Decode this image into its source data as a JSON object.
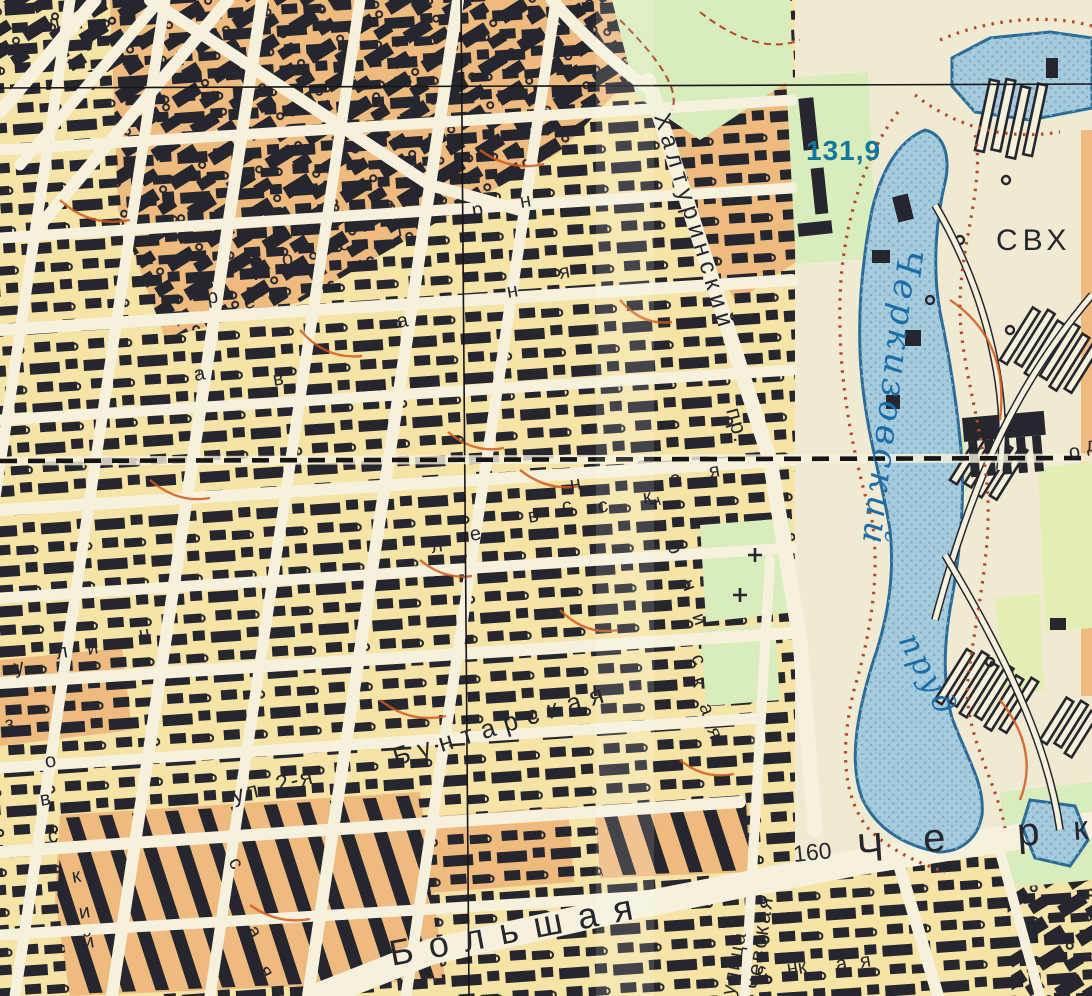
{
  "colors": {
    "paper": "#f1ead3",
    "street": "#f6f1dc",
    "block-yellow": "#f6e3a6",
    "block-orange": "#eeba7e",
    "park-green": "#d9ecbc",
    "park-green2": "#e3eeb2",
    "pond": "#a6cbdc",
    "pond-dot": "#7fb2c8",
    "pond-line": "#2a6b97",
    "ink": "#26262e",
    "grid": "#161616",
    "hachure": "#b04a2a",
    "redline": "#d2591c",
    "blue-text": "#14789c",
    "pond-text": "#1a6da8"
  },
  "map": {
    "labels": [
      {
        "id": "pond-elevation",
        "text": "131,9",
        "x": 806,
        "y": 160,
        "rot": 0,
        "size": 28,
        "color": "blue-text",
        "weight": "bold",
        "spacing": 1
      },
      {
        "id": "sovkhoz",
        "text": "СВХ",
        "x": 996,
        "y": 250,
        "rot": 0,
        "size": 30,
        "color": "ink",
        "spacing": 5
      },
      {
        "id": "street-khalturinsky",
        "text": "Халтуринский",
        "x": 654,
        "y": 116,
        "rot": 73,
        "size": 24,
        "color": "ink",
        "spacing": 6
      },
      {
        "id": "khalturinsky-abbr",
        "text": "пр.",
        "x": 726,
        "y": 410,
        "rot": 75,
        "size": 22,
        "color": "ink",
        "spacing": 2
      },
      {
        "id": "pond-name",
        "text": "Черкизовский",
        "x": 899,
        "y": 248,
        "rot": 97,
        "size": 34,
        "color": "pond-text",
        "italic": true,
        "spacing": 4
      },
      {
        "id": "pond-word",
        "text": "пруд",
        "x": 898,
        "y": 640,
        "rot": 62,
        "size": 31,
        "color": "pond-text",
        "italic": true,
        "spacing": 3
      },
      {
        "id": "street-bolshaya",
        "text": "Большая",
        "x": 392,
        "y": 966,
        "rot": -11,
        "size": 36,
        "color": "ink",
        "spacing": 16
      },
      {
        "id": "house-number-160",
        "text": "160",
        "x": 794,
        "y": 862,
        "rot": -6,
        "size": 23,
        "color": "ink",
        "spacing": 0
      },
      {
        "id": "cherkizovskaya-ch",
        "text": "Ч",
        "x": 858,
        "y": 862,
        "rot": -4,
        "size": 40,
        "color": "ink",
        "spacing": 0
      },
      {
        "id": "cherkizovskaya-e",
        "text": "е",
        "x": 924,
        "y": 852,
        "rot": -4,
        "size": 40,
        "color": "ink",
        "spacing": 0
      },
      {
        "id": "cherkizovskaya-r",
        "text": "р",
        "x": 1018,
        "y": 846,
        "rot": -4,
        "size": 40,
        "color": "ink",
        "spacing": 0
      },
      {
        "id": "cherkizovskaya-k",
        "text": "к",
        "x": 1074,
        "y": 840,
        "rot": -4,
        "size": 34,
        "color": "ink",
        "spacing": 0
      },
      {
        "id": "street-ul-2ya",
        "text": "ул. 2-я",
        "x": 234,
        "y": 803,
        "rot": -14,
        "size": 23,
        "color": "ink",
        "spacing": 2
      },
      {
        "id": "street-buntarskaya",
        "text": "Бунтарская",
        "x": 396,
        "y": 766,
        "rot": -17,
        "size": 26,
        "color": "ink",
        "spacing": 9
      },
      {
        "id": "street-chevskaya",
        "text": "чевская",
        "x": 760,
        "y": 990,
        "rot": -82,
        "size": 22,
        "color": "ink",
        "spacing": 2
      },
      {
        "id": "street-ulitsa-vertical",
        "text": "улица",
        "x": 734,
        "y": 996,
        "rot": -79,
        "size": 20,
        "color": "ink",
        "spacing": 2
      }
    ],
    "scattered_letters": [
      {
        "ch": "р",
        "x": 473,
        "y": 217
      },
      {
        "ch": "н",
        "x": 521,
        "y": 208
      },
      {
        "ch": "н",
        "x": 508,
        "y": 298
      },
      {
        "ch": "я",
        "x": 560,
        "y": 279
      },
      {
        "ch": "а",
        "x": 398,
        "y": 328
      },
      {
        "ch": "л",
        "x": 432,
        "y": 553
      },
      {
        "ch": "е",
        "x": 471,
        "y": 541
      },
      {
        "ch": "в",
        "x": 529,
        "y": 523
      },
      {
        "ch": "с",
        "x": 599,
        "y": 513
      },
      {
        "ch": "к",
        "x": 644,
        "y": 504
      },
      {
        "ch": "у",
        "x": 15,
        "y": 674
      },
      {
        "ch": "л",
        "x": 57,
        "y": 659
      },
      {
        "ch": "и",
        "x": 88,
        "y": 655
      },
      {
        "ch": "ц",
        "x": 140,
        "y": 641
      },
      {
        "ch": "з",
        "x": 6,
        "y": 731
      },
      {
        "ch": "о",
        "x": 46,
        "y": 768
      },
      {
        "ch": "в",
        "x": 41,
        "y": 806
      },
      {
        "ch": "с",
        "x": 49,
        "y": 843
      },
      {
        "ch": "к",
        "x": 73,
        "y": 883
      },
      {
        "ch": "и",
        "x": 80,
        "y": 919
      },
      {
        "ch": "й",
        "x": 84,
        "y": 949
      },
      {
        "ch": "о",
        "x": 283,
        "y": 266
      },
      {
        "ch": "с",
        "x": 340,
        "y": 251
      },
      {
        "ch": "т",
        "x": 396,
        "y": 237
      },
      {
        "ch": "р",
        "x": 208,
        "y": 304
      },
      {
        "ch": "е",
        "x": 245,
        "y": 309
      },
      {
        "ch": "в",
        "x": 274,
        "y": 386
      },
      {
        "ch": "а",
        "x": 195,
        "y": 381
      },
      {
        "ch": "к",
        "x": 799,
        "y": 974
      },
      {
        "ch": "а",
        "x": 837,
        "y": 971
      },
      {
        "ch": "я",
        "x": 861,
        "y": 968
      },
      {
        "ch": "л",
        "x": 49,
        "y": 30
      },
      {
        "ch": "у",
        "x": 86,
        "y": 47
      },
      {
        "ch": "о",
        "x": 1070,
        "y": 459
      },
      {
        "ch": "д",
        "x": 1087,
        "y": 452
      },
      {
        "ch": "с",
        "x": 228,
        "y": 862,
        "rot": 60
      },
      {
        "ch": "а",
        "x": 246,
        "y": 930,
        "rot": 60
      },
      {
        "ch": "я",
        "x": 258,
        "y": 970,
        "rot": 60
      },
      {
        "ch": "т",
        "x": 648,
        "y": 500,
        "rot": 70
      },
      {
        "ch": "о",
        "x": 667,
        "y": 545,
        "rot": 70
      },
      {
        "ch": "н",
        "x": 681,
        "y": 582,
        "rot": 70
      },
      {
        "ch": "и",
        "x": 692,
        "y": 616,
        "rot": 70
      },
      {
        "ch": "с",
        "x": 691,
        "y": 657,
        "rot": 70
      },
      {
        "ch": "к",
        "x": 691,
        "y": 680,
        "rot": 70
      },
      {
        "ch": "а",
        "x": 699,
        "y": 706,
        "rot": 70
      },
      {
        "ch": "я",
        "x": 707,
        "y": 730,
        "rot": 70
      },
      {
        "ch": "а",
        "x": 671,
        "y": 486
      },
      {
        "ch": "я",
        "x": 710,
        "y": 478
      },
      {
        "ch": "с",
        "x": 563,
        "y": 513
      },
      {
        "ch": "н",
        "x": 571,
        "y": 491
      },
      {
        "ch": "с",
        "x": 758,
        "y": 978
      },
      {
        "ch": "н",
        "x": 788,
        "y": 975
      }
    ],
    "symbols": {
      "crosses": [
        {
          "x": 755,
          "y": 555
        },
        {
          "x": 740,
          "y": 595
        }
      ],
      "monument": {
        "x": 256,
        "y": 262
      }
    }
  }
}
